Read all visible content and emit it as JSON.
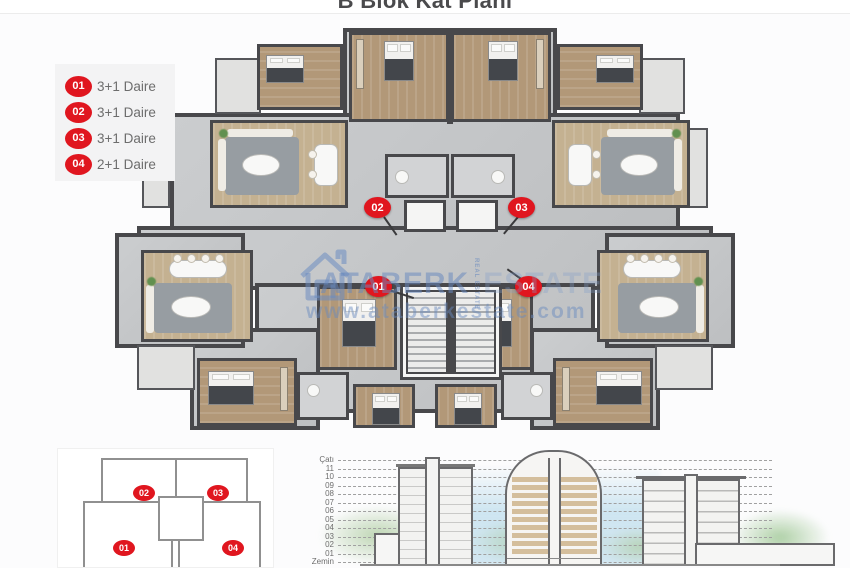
{
  "page": {
    "title": "B Blok Kat Planı"
  },
  "colors": {
    "accent_red": "#e0161f",
    "watermark_blue": "#6889be",
    "wall": "#48484b",
    "wood_floor": "#b29878",
    "marble_floor": "#c6c8ca"
  },
  "legend": {
    "items": [
      {
        "num": "01",
        "label": "3+1 Daire"
      },
      {
        "num": "02",
        "label": "3+1 Daire"
      },
      {
        "num": "03",
        "label": "3+1 Daire"
      },
      {
        "num": "04",
        "label": "2+1 Daire"
      }
    ]
  },
  "plan": {
    "markers": [
      "01",
      "02",
      "03",
      "04"
    ]
  },
  "watermark": {
    "house_icon": "house-icon",
    "brand_primary": "ATABERK",
    "brand_small": "REAL ESTATE",
    "brand_secondary": "ESTATE",
    "url": "www.ataberkestate.com"
  },
  "keyplan": {
    "units": [
      "01",
      "02",
      "03",
      "04"
    ]
  },
  "elevation": {
    "floors": [
      "Çatı",
      "11",
      "10",
      "09",
      "08",
      "07",
      "06",
      "05",
      "04",
      "03",
      "02",
      "01",
      "Zemin"
    ]
  }
}
